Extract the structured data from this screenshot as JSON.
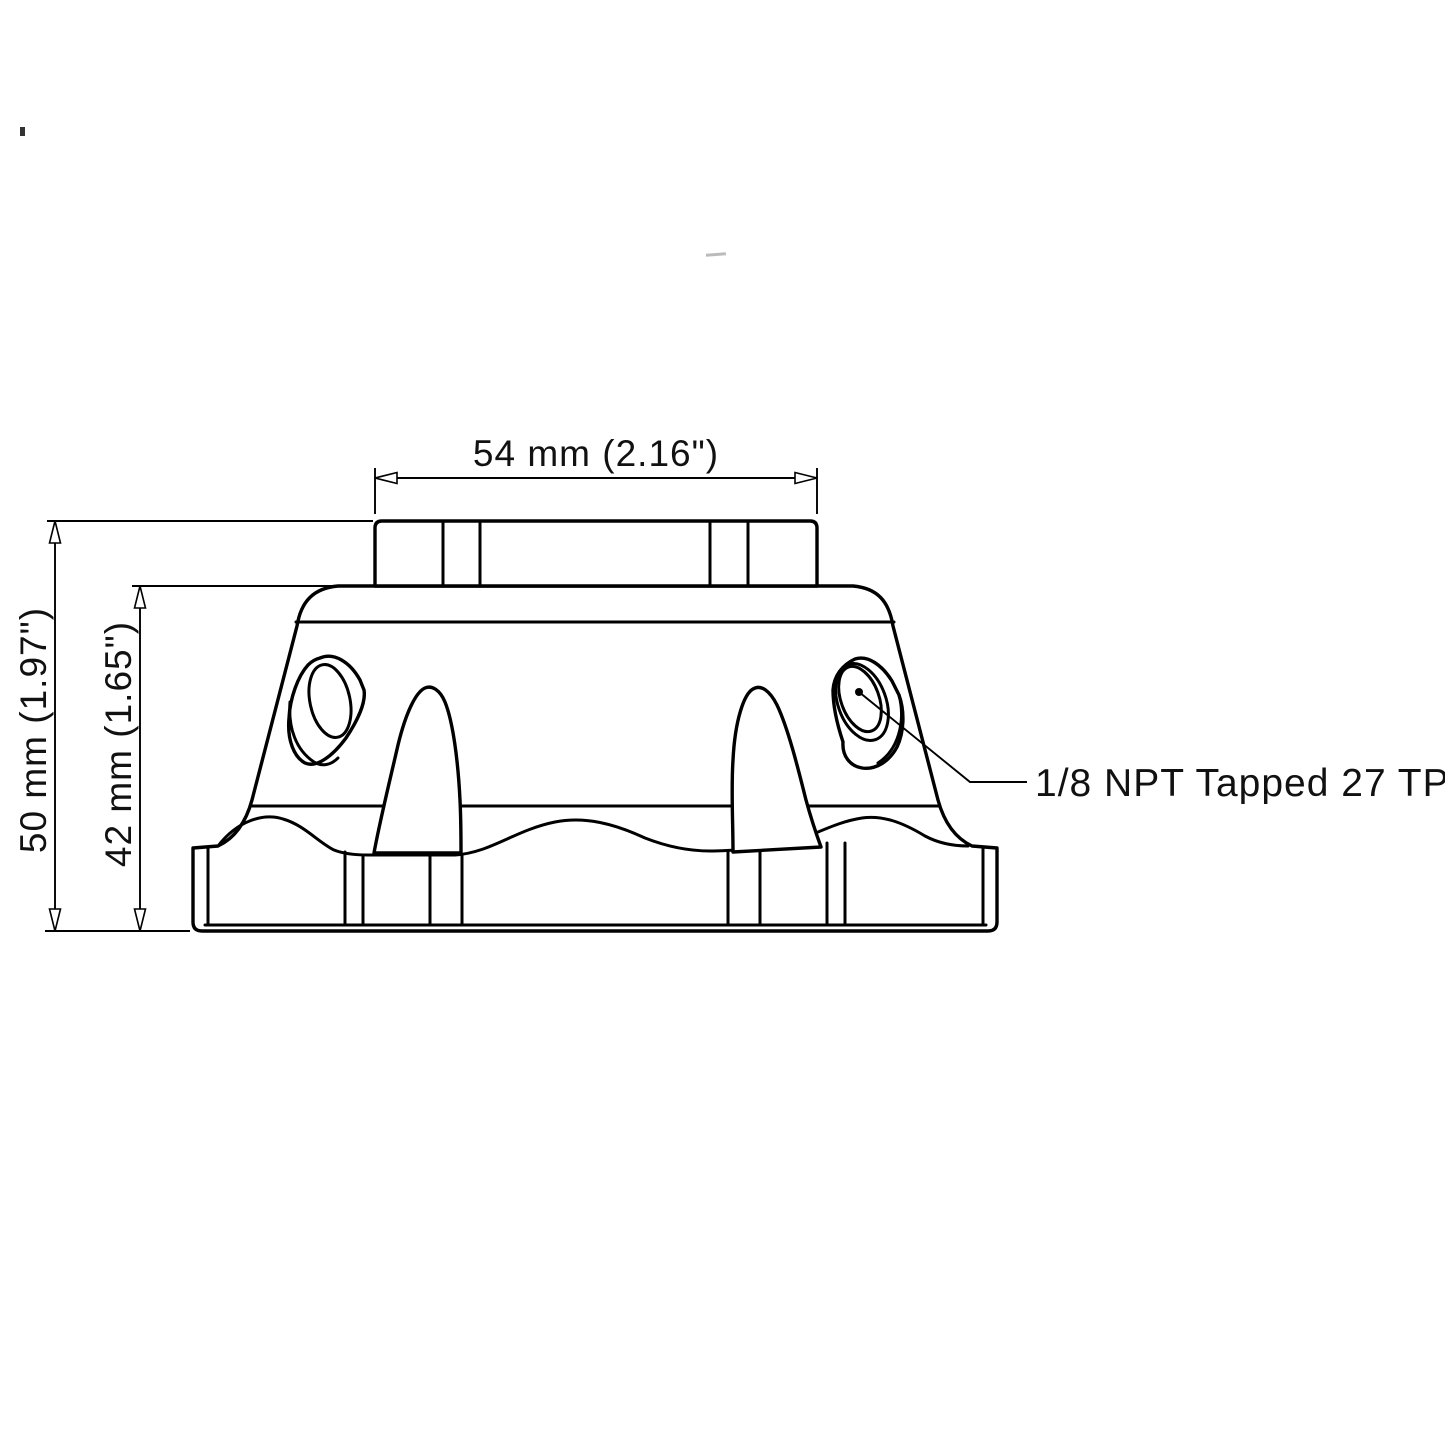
{
  "page": {
    "background": "#ffffff",
    "line_color": "#000000"
  },
  "dimensions": {
    "top_width": {
      "label": "54 mm (2.16\")"
    },
    "overall_height": {
      "label": "50 mm (1.97\")"
    },
    "body_height": {
      "label": "42 mm (1.65\")"
    }
  },
  "callout": {
    "label": "1/8 NPT Tapped 27 TPI"
  }
}
